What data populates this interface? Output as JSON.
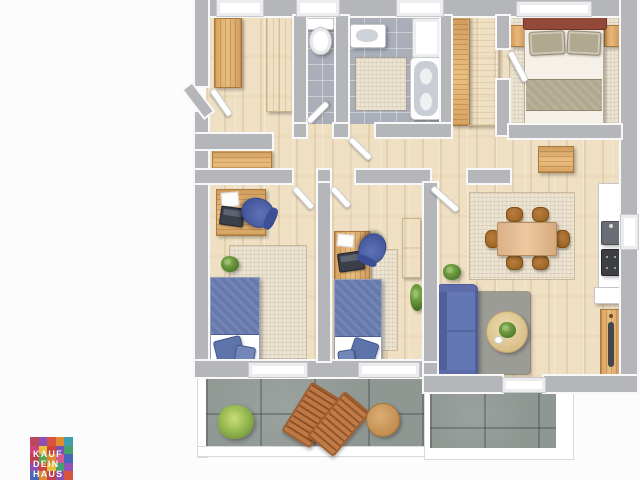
{
  "page": {
    "background": "#fcfcfc",
    "visible_text": [
      "KAUF",
      "DEIN",
      "HAUS"
    ]
  },
  "logo": {
    "lines": [
      "KAUF",
      "DEIN",
      "HAUS"
    ],
    "text_color": "#ffffff",
    "tiles": [
      "#b9485a",
      "#8d4fb3",
      "#d9543f",
      "#e08c2f",
      "#3f9fae",
      "#d1437f",
      "#e7c13a",
      "#cf4436",
      "#7a51b5",
      "#47a06b",
      "#c23f4e",
      "#5aa84d",
      "#e0872f",
      "#d75a92",
      "#4a66b8",
      "#8d4fb3",
      "#cf4436",
      "#e7c13a",
      "#47a06b",
      "#9153b8",
      "#4a66b8",
      "#e0872f",
      "#c23f4e",
      "#8d4fb3",
      "#d9543f"
    ]
  },
  "palette": {
    "wall": "#b4b6b9",
    "wall_edge": "#f8f8f8",
    "wood_a": "#efe0c4",
    "tile": "#a9aeb8",
    "balcony": "#8f9793",
    "rug_light": "#ece4d3",
    "rug_gray": "#9c9c97",
    "bed_blue": "#6679ad",
    "khaki": "#b1a98f",
    "maroon": "#93493a",
    "sofa_blue": "#4f5f9c",
    "wood_furniture": "#d8a263",
    "terrace_table": "#d09a5f"
  },
  "semantics": {
    "scene": "3d-rendered apartment floor plan, top view",
    "rooms": [
      "entry-hall",
      "wc",
      "bathroom",
      "wardrobe-nook",
      "bedroom",
      "hallway",
      "kids-room-left",
      "kids-room-middle",
      "living-dining-kitchen",
      "balcony-left",
      "balcony-right"
    ],
    "furniture": [
      "entry-wardrobe",
      "entry-cabinet",
      "hall-bench",
      "hall-sideboard",
      "toilet",
      "bath-sink",
      "shower-cabinet",
      "bathtub",
      "bath-mat",
      "double-bed",
      "nightstand",
      "wardrobes",
      "desk",
      "office-chair",
      "laptop",
      "single-bed",
      "kids-wardrobe",
      "dining-table",
      "dining-chairs",
      "kitchen-counter",
      "kitchen-sink",
      "stove",
      "sofa",
      "coffee-table",
      "tv-sideboard",
      "plants",
      "sun-loungers",
      "terrace-table",
      "bush"
    ]
  }
}
